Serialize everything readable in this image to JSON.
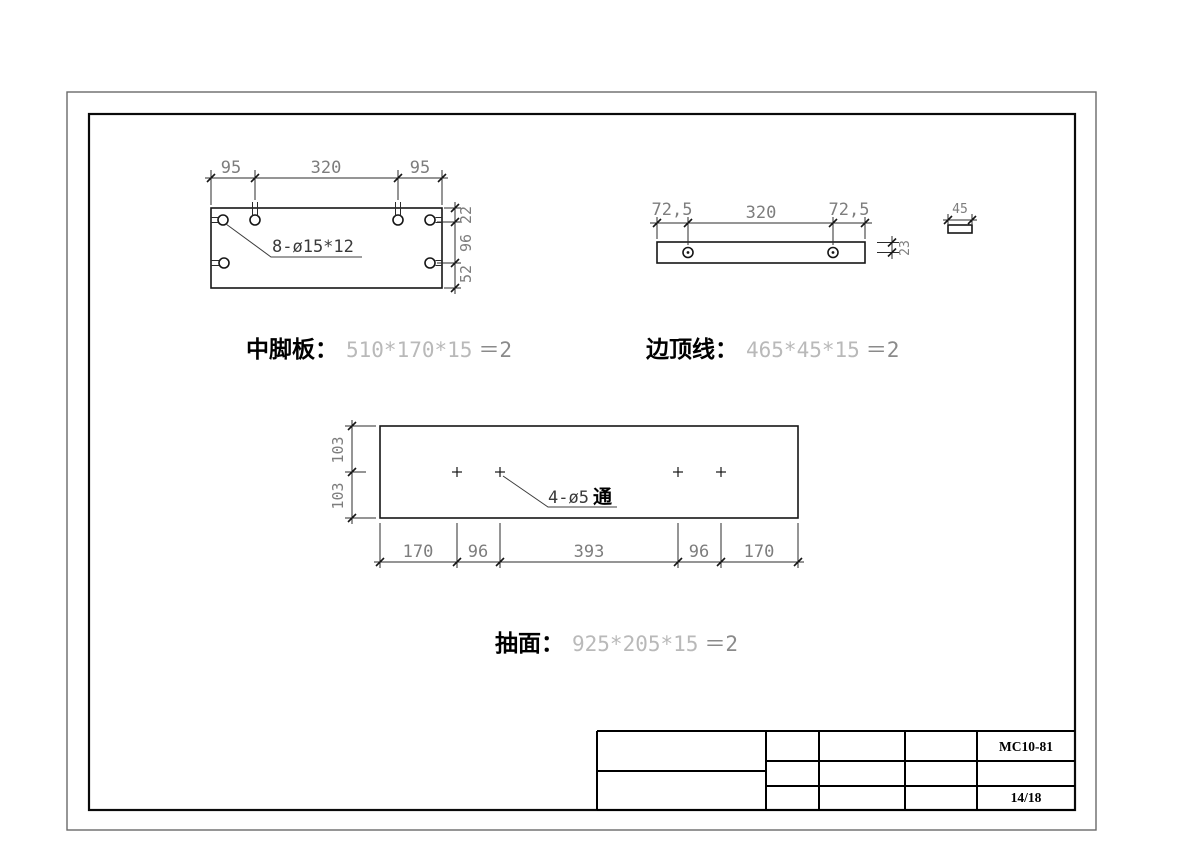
{
  "title_block": {
    "drawing_no": "MC10-81",
    "sheet_no": "14/18"
  },
  "parts": [
    {
      "name": "中脚板：",
      "size": "510*170*15",
      "qty": "＝2",
      "hole_note": "8-ø15*12",
      "dims": {
        "top": [
          "95",
          "320",
          "95"
        ],
        "right": [
          "22",
          "96",
          "52"
        ]
      }
    },
    {
      "name": "边顶线：",
      "size": "465*45*15",
      "qty": "＝2",
      "dims": {
        "top": [
          "72,5",
          "320",
          "72,5"
        ],
        "thickness": "23",
        "end_width": "45"
      }
    },
    {
      "name": "抽面：",
      "size": "925*205*15",
      "qty": "＝2",
      "hole_note_prefix": "4-ø5",
      "hole_note_suffix": "通",
      "dims": {
        "left": [
          "103",
          "103"
        ],
        "bottom": [
          "170",
          "96",
          "393",
          "96",
          "170"
        ]
      }
    }
  ]
}
